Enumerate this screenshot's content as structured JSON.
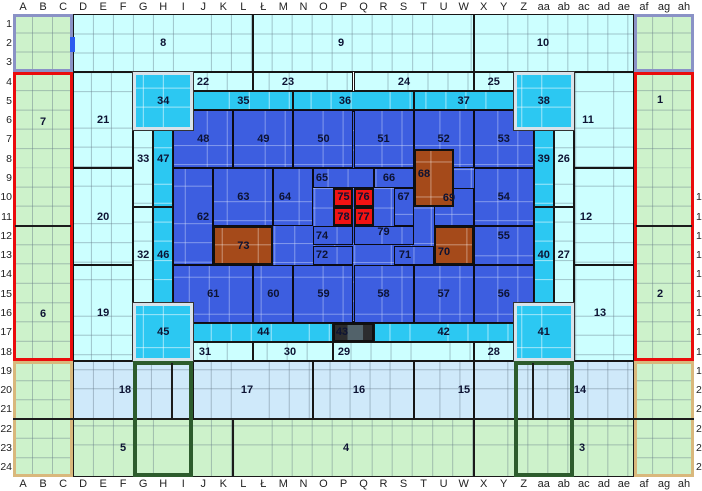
{
  "map_title": "stadium-sector-grid-map",
  "grid": {
    "columns": [
      "A",
      "B",
      "C",
      "D",
      "E",
      "F",
      "G",
      "H",
      "I",
      "J",
      "K",
      "L",
      "Ł",
      "M",
      "N",
      "O",
      "P",
      "Q",
      "R",
      "S",
      "T",
      "U",
      "W",
      "X",
      "Y",
      "Z",
      "aa",
      "ab",
      "ac",
      "ad",
      "ae",
      "af",
      "ag",
      "ah"
    ],
    "rows_left": [
      "1",
      "2",
      "3",
      "4",
      "5",
      "6",
      "7",
      "8",
      "9",
      "10",
      "11",
      "12",
      "13",
      "14",
      "15",
      "16",
      "17",
      "18",
      "19",
      "20",
      "21",
      "22",
      "23",
      "24"
    ],
    "rows_right_clipped": [
      "",
      "",
      "",
      "",
      "",
      "",
      "",
      "",
      "",
      "1",
      "1",
      "1",
      "1",
      "1",
      "1",
      "1",
      "1",
      "1",
      "1",
      "2",
      "2",
      "2",
      "2",
      "2"
    ]
  },
  "colors": {
    "green": "#cdf2cb",
    "ltcyan": "#ccffff",
    "ltblue": "#cfe9fa",
    "cyan": "#2cc8f2",
    "blue": "#3d5ee0",
    "brown": "#a54a1a",
    "red": "#f21313",
    "box-purple": "#8a92c6",
    "box-red": "#ea0c0c",
    "box-tan": "#d9b87c",
    "box-dkgreen": "#2d5c2d",
    "gate-blue": "#2b5cf0"
  },
  "zones": [
    {
      "n": "",
      "name": "green-corner-top-left",
      "cls": "green plain",
      "c": [
        0,
        2
      ],
      "r": [
        1,
        3
      ]
    },
    {
      "n": "",
      "name": "green-corner-top-right",
      "cls": "green plain",
      "c": [
        31,
        33
      ],
      "r": [
        1,
        3
      ]
    },
    {
      "n": "",
      "name": "green-corner-bottom-left",
      "cls": "green plain",
      "c": [
        0,
        2
      ],
      "r": [
        19,
        24
      ]
    },
    {
      "n": "",
      "name": "green-corner-bottom-right",
      "cls": "green plain",
      "c": [
        31,
        33
      ],
      "r": [
        19,
        24
      ]
    },
    {
      "n": "7",
      "cls": "green plain",
      "c": [
        0,
        2
      ],
      "r": [
        4,
        11
      ],
      "ly": 122
    },
    {
      "n": "6",
      "cls": "green plain",
      "c": [
        0,
        2
      ],
      "r": [
        12,
        18
      ],
      "ly": 314
    },
    {
      "n": "1",
      "cls": "green plain",
      "c": [
        31,
        33
      ],
      "r": [
        4,
        11
      ],
      "lx": 660,
      "ly": 100
    },
    {
      "n": "2",
      "cls": "green plain",
      "c": [
        31,
        33
      ],
      "r": [
        12,
        18
      ],
      "lx": 660
    },
    {
      "n": "8",
      "cls": "ltcyan",
      "c": [
        3,
        11
      ],
      "r": [
        1,
        3
      ]
    },
    {
      "n": "9",
      "cls": "ltcyan",
      "c": [
        12,
        22
      ],
      "r": [
        1,
        3
      ],
      "lx": 341
    },
    {
      "n": "10",
      "cls": "ltcyan",
      "c": [
        23,
        30
      ],
      "r": [
        1,
        3
      ],
      "lx": 543
    },
    {
      "n": "21",
      "cls": "ltcyan",
      "c": [
        3,
        5
      ],
      "r": [
        4,
        8
      ]
    },
    {
      "n": "20",
      "cls": "ltcyan",
      "c": [
        3,
        5
      ],
      "r": [
        9,
        13
      ]
    },
    {
      "n": "19",
      "cls": "ltcyan",
      "c": [
        3,
        5
      ],
      "r": [
        14,
        18
      ]
    },
    {
      "n": "11",
      "cls": "ltcyan",
      "c": [
        28,
        30
      ],
      "r": [
        4,
        8
      ],
      "lx": 588
    },
    {
      "n": "12",
      "cls": "ltcyan",
      "c": [
        28,
        30
      ],
      "r": [
        9,
        13
      ],
      "lx": 586
    },
    {
      "n": "13",
      "cls": "ltcyan",
      "c": [
        28,
        30
      ],
      "r": [
        14,
        18
      ],
      "lx": 600
    },
    {
      "n": "22",
      "cls": "ltcyan",
      "c": [
        9,
        11
      ],
      "r": [
        4,
        4
      ],
      "lx": 203
    },
    {
      "n": "23",
      "cls": "ltcyan",
      "c": [
        12,
        16
      ],
      "r": [
        4,
        4
      ],
      "lx": 288
    },
    {
      "n": "24",
      "cls": "ltcyan",
      "c": [
        17,
        22
      ],
      "r": [
        4,
        4
      ],
      "lx": 404
    },
    {
      "n": "25",
      "cls": "ltcyan",
      "c": [
        23,
        24
      ],
      "r": [
        4,
        4
      ]
    },
    {
      "n": "31",
      "cls": "ltcyan",
      "c": [
        9,
        11
      ],
      "r": [
        18,
        18
      ],
      "lx": 205
    },
    {
      "n": "30",
      "cls": "ltcyan",
      "c": [
        12,
        15
      ],
      "r": [
        18,
        18
      ],
      "lx": 290
    },
    {
      "n": "29",
      "cls": "ltcyan",
      "c": [
        16,
        22
      ],
      "r": [
        18,
        18
      ],
      "lx": 344
    },
    {
      "n": "28",
      "cls": "ltcyan",
      "c": [
        23,
        24
      ],
      "r": [
        18,
        18
      ]
    },
    {
      "n": "33",
      "cls": "ltcyan",
      "c": [
        6,
        6
      ],
      "r": [
        7,
        10
      ],
      "ly": 159
    },
    {
      "n": "32",
      "cls": "ltcyan",
      "c": [
        6,
        6
      ],
      "r": [
        11,
        15
      ]
    },
    {
      "n": "26",
      "cls": "ltcyan",
      "c": [
        27,
        27
      ],
      "r": [
        7,
        10
      ],
      "ly": 159
    },
    {
      "n": "27",
      "cls": "ltcyan",
      "c": [
        27,
        27
      ],
      "r": [
        11,
        15
      ]
    },
    {
      "n": "18",
      "cls": "ltblue",
      "c": [
        3,
        8
      ],
      "r": [
        19,
        21
      ],
      "lx": 125
    },
    {
      "n": "17",
      "cls": "ltblue",
      "c": [
        9,
        14
      ],
      "r": [
        19,
        21
      ],
      "lx": 247
    },
    {
      "n": "16",
      "cls": "ltblue",
      "c": [
        15,
        19
      ],
      "r": [
        19,
        21
      ],
      "lx": 359
    },
    {
      "n": "15",
      "cls": "ltblue",
      "c": [
        20,
        22
      ],
      "r": [
        19,
        21
      ],
      "lx": 464
    },
    {
      "n": "14",
      "cls": "ltblue",
      "c": [
        23,
        30
      ],
      "r": [
        19,
        21
      ],
      "lx": 580
    },
    {
      "n": "5",
      "cls": "green bordered",
      "c": [
        3,
        10
      ],
      "r": [
        22,
        24
      ],
      "lx": 123
    },
    {
      "n": "4",
      "cls": "green bordered",
      "c": [
        11,
        22
      ],
      "r": [
        22,
        24
      ],
      "lx": 346
    },
    {
      "n": "3",
      "cls": "green bordered",
      "c": [
        23,
        30
      ],
      "r": [
        22,
        24
      ],
      "lx": 582
    },
    {
      "n": "35",
      "cls": "cyan",
      "c": [
        9,
        13
      ],
      "r": [
        5,
        5
      ]
    },
    {
      "n": "36",
      "cls": "cyan",
      "c": [
        14,
        19
      ],
      "r": [
        5,
        5
      ],
      "lx": 345
    },
    {
      "n": "37",
      "cls": "cyan",
      "c": [
        20,
        24
      ],
      "r": [
        5,
        5
      ]
    },
    {
      "n": "44",
      "cls": "cyan",
      "c": [
        9,
        15
      ],
      "r": [
        17,
        17
      ]
    },
    {
      "n": "42",
      "cls": "cyan",
      "c": [
        18,
        24
      ],
      "r": [
        17,
        17
      ]
    },
    {
      "n": "43",
      "cls": "darkz",
      "c": [
        16,
        17
      ],
      "r": [
        17,
        17
      ],
      "lx": 342
    },
    {
      "n": "47",
      "cls": "cyan",
      "c": [
        7,
        7
      ],
      "r": [
        7,
        10
      ],
      "ly": 159
    },
    {
      "n": "46",
      "cls": "cyan",
      "c": [
        7,
        7
      ],
      "r": [
        11,
        15
      ]
    },
    {
      "n": "39",
      "cls": "cyan",
      "c": [
        26,
        26
      ],
      "r": [
        7,
        10
      ],
      "ly": 159
    },
    {
      "n": "40",
      "cls": "cyan",
      "c": [
        26,
        26
      ],
      "r": [
        11,
        15
      ]
    },
    {
      "n": "",
      "name": "pitch-area",
      "cls": "bluebg",
      "c": [
        8,
        25
      ],
      "r": [
        6,
        16
      ]
    },
    {
      "n": "48",
      "cls": "blue",
      "c": [
        8,
        10
      ],
      "r": [
        6,
        8
      ]
    },
    {
      "n": "49",
      "cls": "blue",
      "c": [
        11,
        13
      ],
      "r": [
        6,
        8
      ]
    },
    {
      "n": "50",
      "cls": "blue",
      "c": [
        14,
        16
      ],
      "r": [
        6,
        8
      ]
    },
    {
      "n": "51",
      "cls": "blue",
      "c": [
        17,
        19
      ],
      "r": [
        6,
        8
      ]
    },
    {
      "n": "52",
      "cls": "blue",
      "c": [
        20,
        22
      ],
      "r": [
        6,
        8
      ]
    },
    {
      "n": "53",
      "cls": "blue",
      "c": [
        23,
        25
      ],
      "r": [
        6,
        8
      ]
    },
    {
      "n": "62",
      "cls": "blue",
      "c": [
        8,
        9
      ],
      "r": [
        9,
        13
      ],
      "lx": 203
    },
    {
      "n": "63",
      "cls": "blue",
      "c": [
        10,
        12
      ],
      "r": [
        9,
        11
      ]
    },
    {
      "n": "64",
      "cls": "blue",
      "c": [
        13,
        14
      ],
      "r": [
        9,
        11
      ],
      "lx": 285
    },
    {
      "n": "65",
      "cls": "blue",
      "c": [
        15,
        17
      ],
      "r": [
        9,
        9
      ],
      "lx": 322
    },
    {
      "n": "66",
      "cls": "blue",
      "c": [
        18,
        19
      ],
      "r": [
        9,
        9
      ],
      "lx": 389
    },
    {
      "n": "67",
      "cls": "blue",
      "c": [
        19,
        19
      ],
      "r": [
        10,
        11
      ],
      "ly": 197
    },
    {
      "n": "69",
      "cls": "blue",
      "c": [
        21,
        22
      ],
      "r": [
        10,
        11
      ],
      "lx": 449,
      "ly": 198
    },
    {
      "n": "54",
      "cls": "blue",
      "c": [
        23,
        25
      ],
      "r": [
        9,
        11
      ]
    },
    {
      "n": "74",
      "cls": "blue",
      "c": [
        15,
        16
      ],
      "r": [
        12,
        12
      ],
      "lx": 322
    },
    {
      "n": "72",
      "cls": "blue",
      "c": [
        15,
        16
      ],
      "r": [
        13,
        13
      ],
      "lx": 322
    },
    {
      "n": "79",
      "cls": "blue",
      "c": [
        17,
        19
      ],
      "r": [
        12,
        12
      ],
      "ly": 232
    },
    {
      "n": "71",
      "cls": "blue",
      "c": [
        19,
        20
      ],
      "r": [
        13,
        13
      ],
      "lx": 405
    },
    {
      "n": "55",
      "cls": "blue",
      "c": [
        23,
        25
      ],
      "r": [
        12,
        13
      ],
      "ly": 236
    },
    {
      "n": "61",
      "cls": "blue",
      "c": [
        8,
        11
      ],
      "r": [
        14,
        16
      ]
    },
    {
      "n": "60",
      "cls": "blue",
      "c": [
        12,
        13
      ],
      "r": [
        14,
        16
      ]
    },
    {
      "n": "59",
      "cls": "blue",
      "c": [
        14,
        16
      ],
      "r": [
        14,
        16
      ]
    },
    {
      "n": "58",
      "cls": "blue",
      "c": [
        17,
        19
      ],
      "r": [
        14,
        16
      ]
    },
    {
      "n": "57",
      "cls": "blue",
      "c": [
        20,
        22
      ],
      "r": [
        14,
        16
      ]
    },
    {
      "n": "56",
      "cls": "blue",
      "c": [
        23,
        25
      ],
      "r": [
        14,
        16
      ]
    },
    {
      "n": "73",
      "cls": "brown",
      "c": [
        10,
        12
      ],
      "r": [
        12,
        13
      ]
    },
    {
      "n": "68",
      "cls": "brown",
      "c": [
        20,
        21
      ],
      "r": [
        8,
        10
      ],
      "lx": 424,
      "ly": 174
    },
    {
      "n": "70",
      "cls": "brown",
      "c": [
        21,
        22
      ],
      "r": [
        12,
        13
      ],
      "lx": 444,
      "ly": 252
    },
    {
      "n": "75",
      "cls": "redz",
      "c": [
        16,
        16
      ],
      "r": [
        10,
        10
      ]
    },
    {
      "n": "76",
      "cls": "redz",
      "c": [
        17,
        17
      ],
      "r": [
        10,
        10
      ]
    },
    {
      "n": "78",
      "cls": "redz",
      "c": [
        16,
        16
      ],
      "r": [
        11,
        11
      ]
    },
    {
      "n": "77",
      "cls": "redz",
      "c": [
        17,
        17
      ],
      "r": [
        11,
        11
      ]
    },
    {
      "n": "34",
      "cls": "cyan silver",
      "c": [
        6,
        8
      ],
      "r": [
        4,
        6
      ]
    },
    {
      "n": "38",
      "cls": "cyan silver",
      "c": [
        25,
        27
      ],
      "r": [
        4,
        6
      ]
    },
    {
      "n": "45",
      "cls": "cyan silver",
      "c": [
        6,
        8
      ],
      "r": [
        16,
        18
      ]
    },
    {
      "n": "41",
      "cls": "cyan silver",
      "c": [
        25,
        27
      ],
      "r": [
        16,
        18
      ]
    }
  ],
  "overlays": [
    {
      "name": "corner-box-top-left",
      "type": "box",
      "cls": "purple",
      "x": 13,
      "y": 14,
      "w": 60,
      "h": 58
    },
    {
      "name": "corner-box-top-right",
      "type": "box",
      "cls": "purple",
      "x": 634,
      "y": 14,
      "w": 60,
      "h": 58
    },
    {
      "name": "vip-box-left",
      "type": "box",
      "cls": "red",
      "x": 13,
      "y": 72,
      "w": 60,
      "h": 289
    },
    {
      "name": "vip-box-right",
      "type": "box",
      "cls": "red",
      "x": 634,
      "y": 72,
      "w": 60,
      "h": 289
    },
    {
      "name": "vip-divider-left",
      "type": "line",
      "x": 15,
      "y": 225,
      "w": 56,
      "h": 2
    },
    {
      "name": "vip-divider-right",
      "type": "line",
      "x": 636,
      "y": 225,
      "w": 56,
      "h": 2
    },
    {
      "name": "corner-box-bottom-left",
      "type": "box",
      "cls": "tan",
      "x": 13,
      "y": 361,
      "w": 60,
      "h": 116
    },
    {
      "name": "corner-box-bottom-right",
      "type": "box",
      "cls": "tan",
      "x": 634,
      "y": 361,
      "w": 60,
      "h": 116
    },
    {
      "name": "row21-22-line",
      "type": "line",
      "x": 13,
      "y": 418,
      "w": 681,
      "h": 2
    },
    {
      "name": "stair-box-left",
      "type": "box",
      "cls": "dkgreen",
      "x": 133,
      "y": 361,
      "w": 60,
      "h": 116
    },
    {
      "name": "stair-box-right",
      "type": "box",
      "cls": "dkgreen",
      "x": 514,
      "y": 361,
      "w": 60,
      "h": 116
    },
    {
      "name": "stair-divider-left",
      "type": "line",
      "x": 171,
      "y": 363,
      "w": 2,
      "h": 55
    },
    {
      "name": "stair-divider-right",
      "type": "line",
      "x": 532,
      "y": 363,
      "w": 2,
      "h": 55
    },
    {
      "name": "gate-marker",
      "type": "line",
      "x": 70,
      "y": 37,
      "w": 5,
      "h": 15,
      "color": "#2b5cf0"
    }
  ]
}
